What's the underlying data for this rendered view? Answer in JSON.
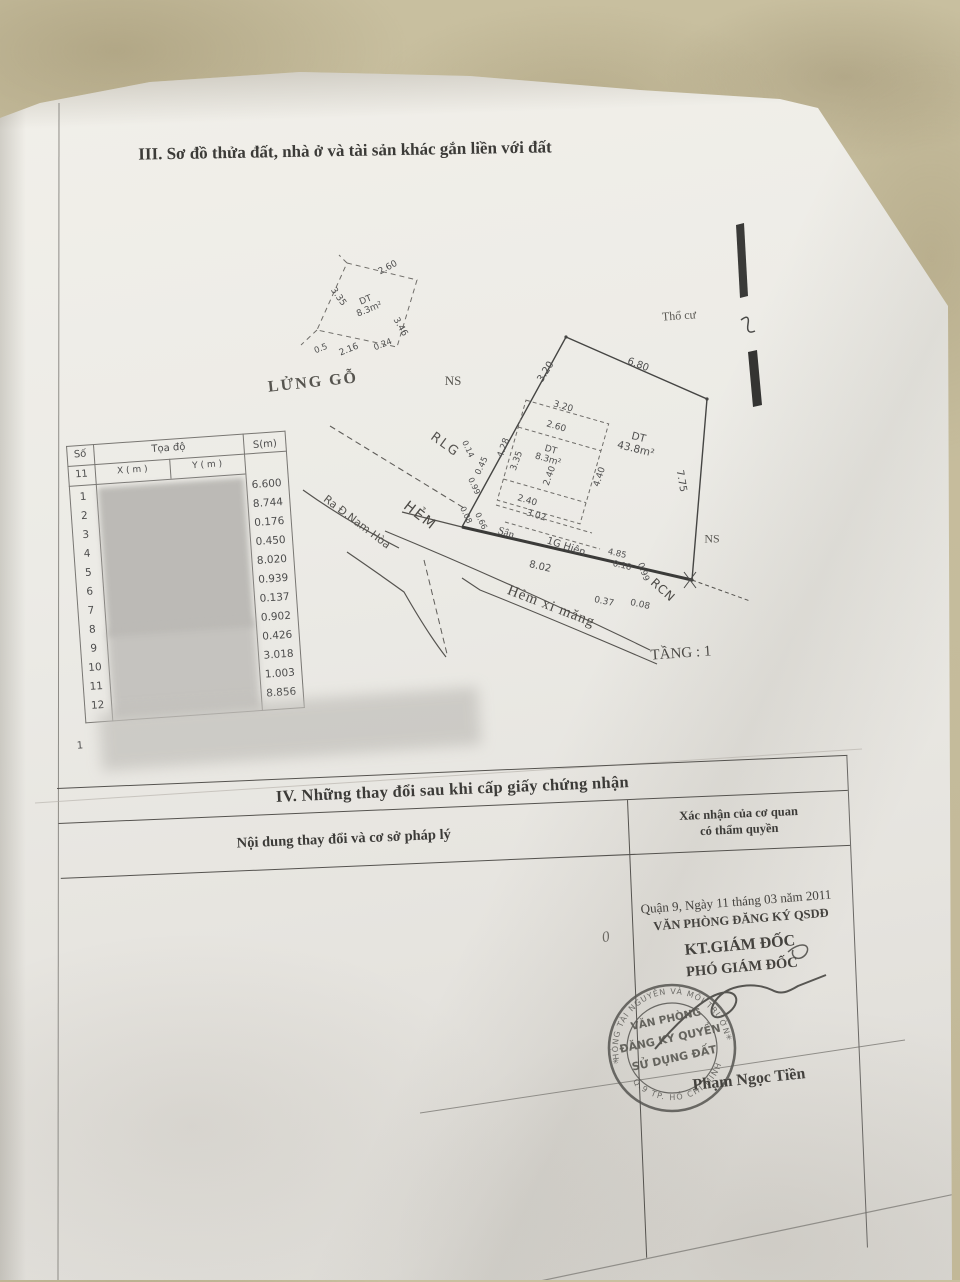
{
  "meta": {
    "paper_color": "#efede8",
    "background_color": "#c6bc9d",
    "ink_color": "#4a4a4a",
    "document_kind": "scanned land-use-right certificate page (Vietnam)"
  },
  "section3": {
    "title": "III. Sơ đồ thửa đất, nhà ở và tài sản khác gắn liền với đất"
  },
  "diagram": {
    "mezzanine": {
      "name": "LỬNG GỖ",
      "dt_line1": "DT",
      "dt_line2": "8.3m²",
      "dim_top": "2.60",
      "dim_left": "3.35",
      "dim_right": "3.46",
      "dim_bottom": "2.16",
      "dim_bottom_small": "0.24",
      "dim_corner": "0.5"
    },
    "ns_left": "NS",
    "ns_right": "NS",
    "tho_cu": "Thổ cư",
    "rlg": "RLG",
    "hem": "HẺM",
    "ra_duong": "Ra Đ.Nam Hòa",
    "hem_xi_mang": "Hẻm xi măng",
    "tang": "TẦNG : 1",
    "rcn": "RCN",
    "parcel": {
      "dt_line1": "DT",
      "dt_line2": "43.8m²",
      "edge_left": "3.20",
      "edge_top": "6.80",
      "edge_right": "7.75",
      "edge_bottom": "8.02"
    },
    "house": {
      "dt_line1": "DT",
      "dt_line2": "8.3m²",
      "dim_top": "3.20",
      "dim_top2": "2.60",
      "dim_left_outer": "4.28",
      "dim_left": "3.35",
      "dim_left_small": "0.45",
      "dim_mid": "2.40",
      "dim_right_outer": "4.40",
      "dim_bottom": "2.40",
      "dim_bottom2": "3.02",
      "san": "Sân",
      "hien": "1G Hiên",
      "small_dims": [
        "0.14",
        "0.99",
        "0.08",
        "0.66"
      ],
      "front_dims": [
        "4.85",
        "0.18",
        "0.99",
        "0.37",
        "0.08"
      ]
    }
  },
  "coord_table": {
    "col_no": "Số",
    "col_no2": "11",
    "col_group": "Tọa độ",
    "col_x": "X ( m )",
    "col_y": "Y ( m )",
    "col_s": "S(m)",
    "rows": [
      {
        "no": "1",
        "s": "6.600"
      },
      {
        "no": "2",
        "s": "8.744"
      },
      {
        "no": "3",
        "s": "0.176"
      },
      {
        "no": "4",
        "s": "0.450"
      },
      {
        "no": "5",
        "s": "8.020"
      },
      {
        "no": "6",
        "s": "0.939"
      },
      {
        "no": "7",
        "s": "0.137"
      },
      {
        "no": "8",
        "s": "0.902"
      },
      {
        "no": "9",
        "s": "0.426"
      },
      {
        "no": "10",
        "s": "3.018"
      },
      {
        "no": "11",
        "s": "1.003"
      },
      {
        "no": "12",
        "s": "8.856"
      }
    ],
    "footer_no": "1"
  },
  "section4": {
    "title": "IV. Những thay đổi sau khi cấp giấy chứng nhận",
    "col_content": "Nội dung thay đổi và cơ sở pháp lý",
    "col_confirm_line1": "Xác nhận của cơ quan",
    "col_confirm_line2": "có thẩm quyền",
    "handwritten_mark": "0",
    "confirmation": {
      "date_line": "Quận 9, Ngày 11 tháng 03 năm 2011",
      "office": "VĂN PHÒNG ĐĂNG KÝ QSDĐ",
      "kt": "KT.GIÁM ĐỐC",
      "pho": "PHÓ GIÁM ĐỐC",
      "signer_name": "Phạm Ngọc Tiền"
    },
    "stamp": {
      "line1": "VĂN PHÒNG",
      "line2": "ĐĂNG KÝ QUYỀN",
      "line3": "SỬ DỤNG ĐẤT",
      "ring_top": "PHÒNG TÀI NGUYÊN VÀ MÔI TRƯỜNG",
      "ring_bottom": "Q.9 TP. HỒ CHÍ MINH",
      "star": "✳"
    }
  }
}
